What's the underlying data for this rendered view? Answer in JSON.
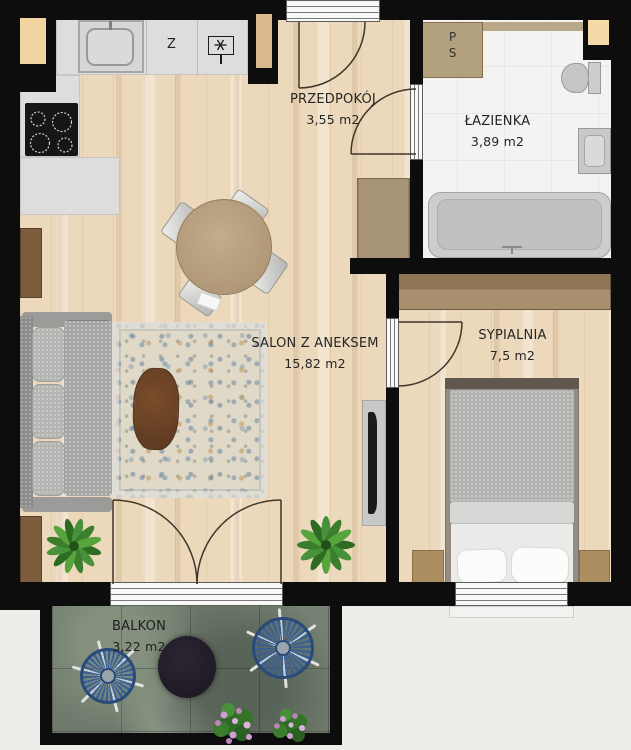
{
  "rooms": {
    "hallway": {
      "name": "PRZEDPOKÓJ",
      "area": "3,55 m2"
    },
    "bathroom": {
      "name": "ŁAZIENKA",
      "area": "3,89 m2"
    },
    "living": {
      "name": "SALON Z ANEKSEM",
      "area": "15,82 m2"
    },
    "bedroom": {
      "name": "SYPIALNIA",
      "area": "7,5 m2"
    },
    "balcony": {
      "name": "BALKON",
      "area": "3,22 m2"
    }
  },
  "appliances": {
    "dishwasher_label": "Z",
    "washer_label": "P",
    "dryer_label": "S",
    "hood_icon": "asterisk-in-box"
  },
  "colors": {
    "wall": "#0d0d0d",
    "wood_floor": "#ecd8ba",
    "tile_floor": "#f4f3f1",
    "stone_floor": "#6f7a6c",
    "counter": "#dedddb",
    "sofa": "#a8a8a6",
    "bed_blanket": "#b2b2b0",
    "furniture_wood": "#ac8e60",
    "chair_blue": "#3a5f93",
    "background": "#efede9"
  }
}
